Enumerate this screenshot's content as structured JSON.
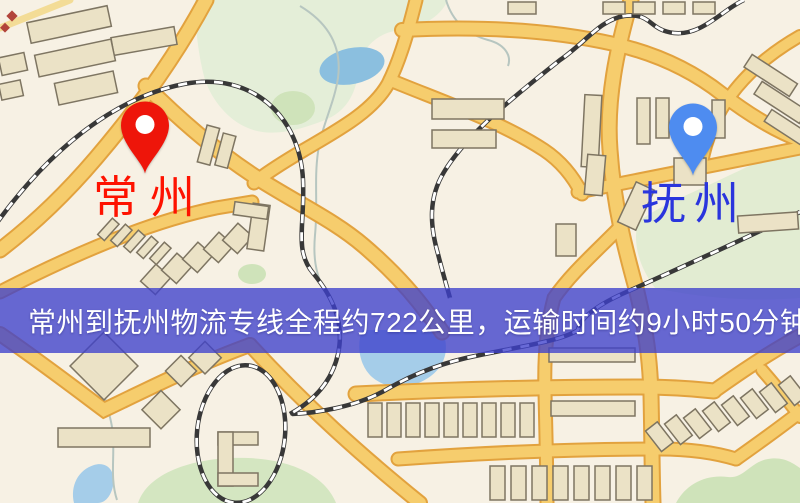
{
  "map": {
    "markers": [
      {
        "id": "origin",
        "label": "常州",
        "pin_color": "#ee150a",
        "label_color": "#fe1200"
      },
      {
        "id": "destination",
        "label": "抚州",
        "pin_color": "#4e8cf0",
        "label_color": "#2a35dd"
      }
    ],
    "banner": {
      "text": "常州到抚州物流专线全程约722公里，运输时间约9小时50分钟.",
      "background_color": "#3e40cc",
      "text_color": "#ffffff"
    },
    "route_info": {
      "origin": "常州",
      "destination": "抚州",
      "distance_text": "约722公里",
      "duration_text": "约9小时50分钟"
    }
  },
  "colors": {
    "map_background": "#f7f1e4",
    "road_fill": "#f6cd6d",
    "road_casing": "#e2a23e",
    "minor_road": "#f3dc96",
    "water": "#9fcae6",
    "park": "#e2ecd2",
    "building_fill": "#ebe2c6",
    "building_stroke": "#7e7562",
    "railway": "#383838"
  }
}
